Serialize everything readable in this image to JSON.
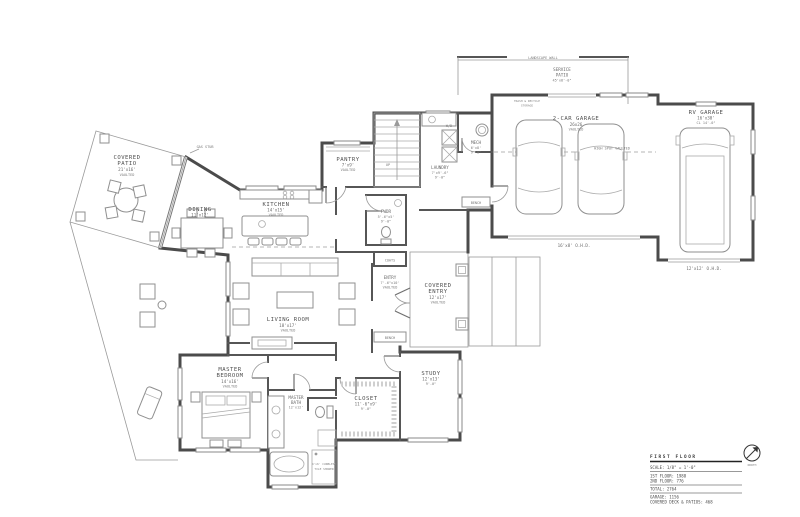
{
  "title_block": {
    "title": "FIRST FLOOR",
    "scale": "SCALE: 1/8\" = 1'-0\"",
    "north": "NORTH",
    "area_lines": [
      "1ST FLOOR: 1988",
      "2ND FLOOR: 776",
      "TOTAL: 2764",
      "GARAGE: 1156",
      "COVERED DECK & PATIOS: 468"
    ]
  },
  "rooms": {
    "covered_patio": {
      "name1": "COVERED",
      "name2": "PATIO",
      "dims": "21'x16'",
      "note": "VAULTED"
    },
    "dining": {
      "name": "DINING",
      "dims": "11'x12'"
    },
    "kitchen": {
      "name": "KITCHEN",
      "dims": "14'x15'",
      "note": "VAULTED"
    },
    "pantry": {
      "name": "PANTRY",
      "dims": "7'x9'",
      "note": "VAULTED"
    },
    "living_room": {
      "name": "LIVING ROOM",
      "dims": "18'x17'",
      "note": "VAULTED"
    },
    "entry": {
      "name": "ENTRY",
      "dims": "7'-6\"x10'",
      "note": "VAULTED"
    },
    "covered_entry": {
      "name1": "COVERED",
      "name2": "ENTRY",
      "dims": "12'x17'",
      "note": "VAULTED"
    },
    "laundry": {
      "name": "LAUNDRY",
      "dims": "7'x9'-6\"",
      "note": "9'-0\""
    },
    "mech": {
      "name": "MECH",
      "dims": "6'x8'",
      "note": "9'-0\""
    },
    "powder": {
      "name": "PWDR",
      "dims": "5'-6\"x5'",
      "note": "9'-0\""
    },
    "master_bedroom": {
      "name1": "MASTER",
      "name2": "BEDROOM",
      "dims": "14'x16'",
      "note": "VAULTED"
    },
    "master_bath": {
      "name1": "MASTER",
      "name2": "BATH",
      "dims": "12'x12'"
    },
    "closet": {
      "name": "CLOSET",
      "dims": "11'-6\"x9'",
      "note": "9'-0\""
    },
    "study": {
      "name": "STUDY",
      "dims": "12'x13'",
      "note": "9'-0\""
    },
    "two_car_garage": {
      "name": "2-CAR GARAGE",
      "dims": "26x26",
      "note": "VAULTED"
    },
    "rv_garage": {
      "name": "RV GARAGE",
      "dims": "16'x30'",
      "note": "CL 14'-0\""
    },
    "service_patio": {
      "name1": "SERVICE",
      "name2": "PATIO",
      "dims": "45'x8'-0\""
    }
  },
  "annotations": {
    "landscape_wall": "LANDSCAPE WALL",
    "gas_stub": "GAS STUB",
    "high_spot": "HIGH SPOT VAULTED",
    "trash1": "TRASH & RECYCLE",
    "trash2": "STORAGE",
    "coats": "COATS",
    "bench": "BENCH",
    "up": "UP",
    "wd": "W/D",
    "ohd_garage": "16'x8' O.H.D.",
    "ohd_rv": "12'x12' O.H.D.",
    "shower1": "4'x6' CURBLESS",
    "shower2": "TILE SHOWER"
  }
}
